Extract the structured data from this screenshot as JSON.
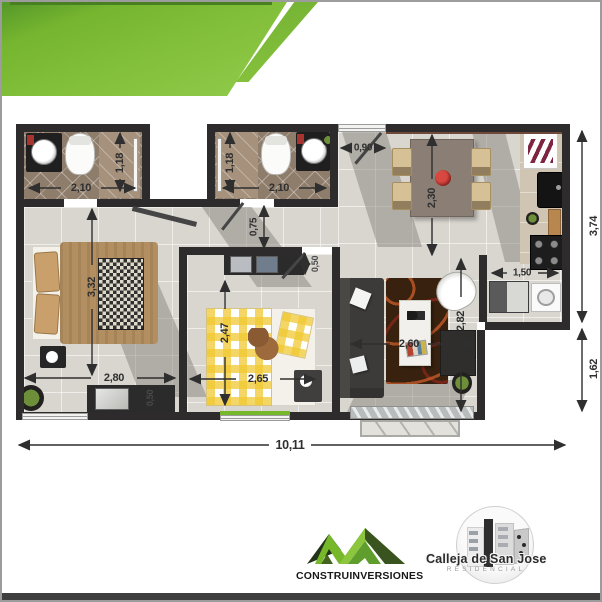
{
  "poster": {
    "banner": {
      "line1": "Apartamento de 2",
      "line2": "Habitaciones (Ampliacion)"
    },
    "logos": {
      "construinversiones": "CONSTRUINVERSIONES",
      "calleja_name": "Calleja de San Jose",
      "calleja_subtitle": "RESIDENCIAL"
    },
    "colors": {
      "banner_green_light": "#8CC63F",
      "banner_green_dark": "#4E9B33",
      "banner_top_edge": "#477F21",
      "wall": "#2D2B2C",
      "floor": "#D9D6D0",
      "bathroom_tile": "#8F7D6B",
      "accent_green": "#76B82A",
      "dimension_text": "#2F2F2F",
      "bottom_bar": "#3F3F3F"
    }
  },
  "plan": {
    "dims": {
      "bath1_width": "2,10",
      "bath1_shower_depth": "1,18",
      "bath2_width": "2,10",
      "bath2_shower_depth": "1,18",
      "entry_width": "0,90",
      "dining_depth": "2,30",
      "kitchen_side": "3,74",
      "hall_width": "0,75",
      "closet2_depth": "0,50",
      "bed1_length": "3,32",
      "bed1_width": "2,80",
      "closet1_depth": "0,50",
      "bed2_length": "2,47",
      "bed2_width": "2,65",
      "living_length": "2,82",
      "living_width": "2,60",
      "laundry_width": "1,50",
      "terrace_side": "1,62",
      "total_width": "10,11"
    }
  }
}
